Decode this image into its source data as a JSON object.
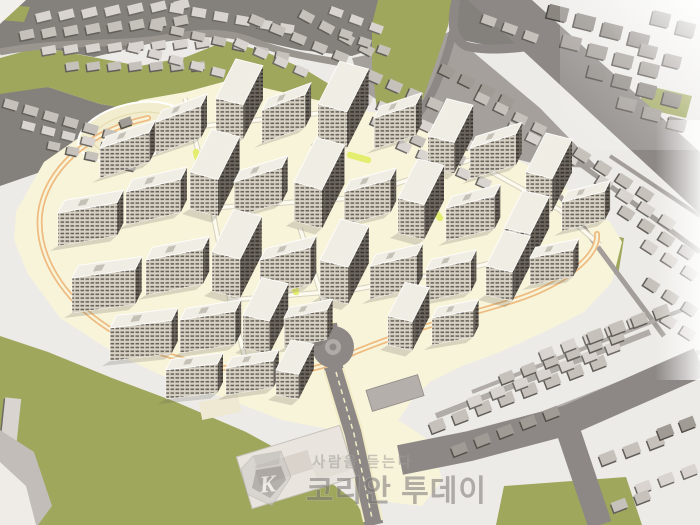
{
  "meta": {
    "description": "3D aerial bird's-eye rendering of a planned apartment complex redevelopment surrounded by existing low-rise city blocks, parks and roads",
    "image_type": "architectural massing rendering"
  },
  "watermark": {
    "logo_letter": "K",
    "slogan": "사람을 듣는다",
    "brand": "코리안 투데이"
  },
  "palette": {
    "base": "#ecebe7",
    "city_street": "#84807c",
    "city_ground": "#a5a09b",
    "road": "#8d8885",
    "road_mid": "#9b9590",
    "street_light": "#aaa5a0",
    "park": "#9ea75c",
    "site": "#f8f4da",
    "plaza": "#f3edcf",
    "plaza_ring": "#e6dcb2",
    "path_orange": "#eebb80",
    "path_yellow": "#e3ee71",
    "road_white": "#fcfaee",
    "road_casing": "#d8d2bf",
    "median_cream": "#f1ebc6",
    "roundabout_island": "#b0aba6",
    "roof": "#f0ede4",
    "roof_edge": "#ffffff",
    "roof_detail": "#c6c1b7",
    "face_light_bg": "#d8d2c4",
    "face_light_win": "#55504a",
    "face_dark_bg": "#6b655d",
    "face_dark_win": "#312d28",
    "tower_shadow": "rgba(100,95,80,0.22)",
    "school": "#e9e5de",
    "school_court": "#d9d3cb",
    "flat_gray": "#b4afab",
    "corner_wedge": "#c2bdb8",
    "corner_white": "#efece8",
    "wm_badge_light": "#cbc7c4",
    "wm_badge_mid": "#b5b1ae",
    "wm_badge_dark": "#8a8683",
    "wm_text": "#7a7674",
    "wm_text_light": "#a09c9a"
  },
  "scene": {
    "block_shades": [
      [
        "#d9d4cf",
        "#6e6a66"
      ],
      [
        "#c6c1bb",
        "#615d59"
      ],
      [
        "#a19b95",
        "#565älte0"
      ],
      [
        "#8b8680",
        "#4a4642"
      ]
    ],
    "blocks": [
      [
        36,
        12,
        7,
        23,
        -2,
        15,
        9,
        -14,
        0
      ],
      [
        20,
        30,
        8,
        22,
        -2,
        14,
        9,
        -12,
        1
      ],
      [
        42,
        46,
        8,
        22,
        -1,
        14,
        8,
        -10,
        0
      ],
      [
        66,
        62,
        7,
        21,
        0,
        13,
        8,
        -8,
        1
      ],
      [
        170,
        4,
        6,
        22,
        4,
        14,
        9,
        10,
        0
      ],
      [
        150,
        22,
        7,
        21,
        5,
        13,
        8,
        12,
        1
      ],
      [
        128,
        44,
        6,
        21,
        6,
        13,
        8,
        14,
        0
      ],
      [
        250,
        16,
        5,
        21,
        9,
        14,
        9,
        22,
        1
      ],
      [
        235,
        40,
        4,
        20,
        9,
        13,
        8,
        24,
        0
      ],
      [
        300,
        12,
        4,
        20,
        11,
        14,
        9,
        28,
        1
      ],
      [
        330,
        8,
        3,
        20,
        8,
        13,
        8,
        20,
        0
      ],
      [
        340,
        30,
        3,
        19,
        8,
        12,
        8,
        20,
        1
      ],
      [
        482,
        16,
        3,
        21,
        8,
        14,
        9,
        20,
        1
      ],
      [
        4,
        100,
        6,
        20,
        6,
        14,
        9,
        16,
        1
      ],
      [
        22,
        122,
        6,
        20,
        5,
        13,
        8,
        14,
        0
      ],
      [
        48,
        142,
        5,
        19,
        5,
        12,
        8,
        12,
        1
      ],
      [
        120,
        118,
        1,
        0,
        0,
        12,
        8,
        -20,
        2
      ],
      [
        368,
        72,
        5,
        20,
        9,
        14,
        10,
        24,
        1
      ],
      [
        358,
        94,
        6,
        20,
        9,
        14,
        9,
        24,
        0
      ],
      [
        372,
        118,
        6,
        20,
        9,
        13,
        9,
        24,
        1
      ],
      [
        398,
        142,
        5,
        20,
        9,
        13,
        9,
        24,
        0
      ],
      [
        440,
        66,
        4,
        20,
        10,
        14,
        10,
        26,
        2
      ],
      [
        476,
        94,
        4,
        19,
        10,
        13,
        9,
        26,
        1
      ],
      [
        508,
        124,
        4,
        19,
        10,
        13,
        9,
        26,
        0
      ],
      [
        548,
        6,
        4,
        27,
        9,
        20,
        14,
        14,
        3
      ],
      [
        562,
        36,
        4,
        26,
        9,
        19,
        13,
        14,
        2
      ],
      [
        588,
        66,
        4,
        25,
        9,
        18,
        13,
        14,
        3
      ],
      [
        618,
        98,
        3,
        25,
        10,
        18,
        12,
        14,
        2
      ],
      [
        652,
        12,
        2,
        25,
        10,
        18,
        14,
        14,
        3
      ],
      [
        640,
        45,
        2,
        24,
        10,
        17,
        12,
        14,
        2
      ],
      [
        575,
        150,
        4,
        21,
        13,
        15,
        10,
        33,
        1
      ],
      [
        597,
        178,
        4,
        21,
        13,
        15,
        10,
        33,
        0
      ],
      [
        620,
        208,
        4,
        20,
        13,
        14,
        10,
        33,
        1
      ],
      [
        643,
        242,
        3,
        20,
        13,
        14,
        10,
        33,
        0
      ],
      [
        645,
        280,
        3,
        19,
        12,
        14,
        10,
        33,
        1
      ],
      [
        662,
        316,
        2,
        19,
        12,
        14,
        10,
        33,
        0
      ],
      [
        430,
        420,
        8,
        23,
        -9,
        15,
        11,
        -21,
        1
      ],
      [
        452,
        444,
        5,
        23,
        -9,
        15,
        10,
        -21,
        2
      ],
      [
        468,
        396,
        7,
        23,
        -9,
        14,
        10,
        -21,
        0
      ],
      [
        500,
        372,
        6,
        22,
        -8,
        14,
        10,
        -21,
        1
      ],
      [
        540,
        348,
        5,
        22,
        -8,
        14,
        10,
        -21,
        0
      ],
      [
        588,
        330,
        4,
        22,
        -8,
        15,
        11,
        -21,
        1
      ],
      [
        600,
        452,
        3,
        24,
        -8,
        16,
        11,
        -21,
        1
      ],
      [
        636,
        482,
        3,
        23,
        -8,
        15,
        10,
        -21,
        0
      ],
      [
        658,
        426,
        2,
        22,
        -8,
        15,
        11,
        -21,
        2
      ],
      [
        612,
        500,
        2,
        23,
        -8,
        15,
        10,
        -21,
        1
      ],
      [
        2,
        398,
        1,
        0,
        0,
        16,
        62,
        6,
        0
      ],
      [
        0,
        470,
        1,
        0,
        0,
        18,
        34,
        10,
        1
      ]
    ],
    "towers": [
      [
        100,
        148,
        52,
        -18,
        13,
        30
      ],
      [
        156,
        122,
        48,
        -20,
        13,
        32
      ],
      [
        216,
        98,
        28,
        14,
        44,
        34
      ],
      [
        262,
        110,
        46,
        -20,
        13,
        33
      ],
      [
        318,
        104,
        30,
        15,
        48,
        36
      ],
      [
        374,
        118,
        44,
        -18,
        13,
        31
      ],
      [
        428,
        136,
        27,
        14,
        42,
        31
      ],
      [
        470,
        148,
        48,
        -17,
        13,
        31
      ],
      [
        526,
        172,
        27,
        14,
        44,
        33
      ],
      [
        562,
        202,
        44,
        -14,
        12,
        29
      ],
      [
        58,
        213,
        60,
        -10,
        14,
        33
      ],
      [
        126,
        192,
        56,
        -13,
        14,
        33
      ],
      [
        190,
        172,
        29,
        15,
        48,
        37
      ],
      [
        234,
        182,
        50,
        -17,
        13,
        35
      ],
      [
        294,
        182,
        29,
        15,
        50,
        39
      ],
      [
        344,
        192,
        48,
        -15,
        13,
        33
      ],
      [
        398,
        198,
        27,
        14,
        44,
        35
      ],
      [
        446,
        208,
        50,
        -14,
        13,
        33
      ],
      [
        504,
        228,
        27,
        13,
        42,
        31
      ],
      [
        72,
        278,
        64,
        -8,
        14,
        35
      ],
      [
        146,
        260,
        58,
        -11,
        14,
        35
      ],
      [
        212,
        252,
        29,
        14,
        48,
        39
      ],
      [
        260,
        260,
        52,
        -14,
        13,
        37
      ],
      [
        320,
        260,
        29,
        14,
        46,
        37
      ],
      [
        370,
        266,
        48,
        -13,
        13,
        33
      ],
      [
        426,
        270,
        46,
        -12,
        12,
        31
      ],
      [
        486,
        266,
        27,
        13,
        40,
        29
      ],
      [
        530,
        258,
        44,
        -11,
        12,
        27
      ],
      [
        110,
        328,
        62,
        -7,
        14,
        33
      ],
      [
        180,
        320,
        56,
        -9,
        13,
        33
      ],
      [
        243,
        315,
        27,
        13,
        42,
        33
      ],
      [
        284,
        318,
        44,
        -11,
        12,
        30
      ],
      [
        388,
        316,
        25,
        13,
        38,
        29
      ],
      [
        432,
        318,
        42,
        -11,
        12,
        27
      ],
      [
        166,
        370,
        52,
        -7,
        12,
        29
      ],
      [
        226,
        368,
        48,
        -9,
        12,
        27
      ],
      [
        276,
        370,
        23,
        11,
        34,
        25
      ]
    ]
  }
}
